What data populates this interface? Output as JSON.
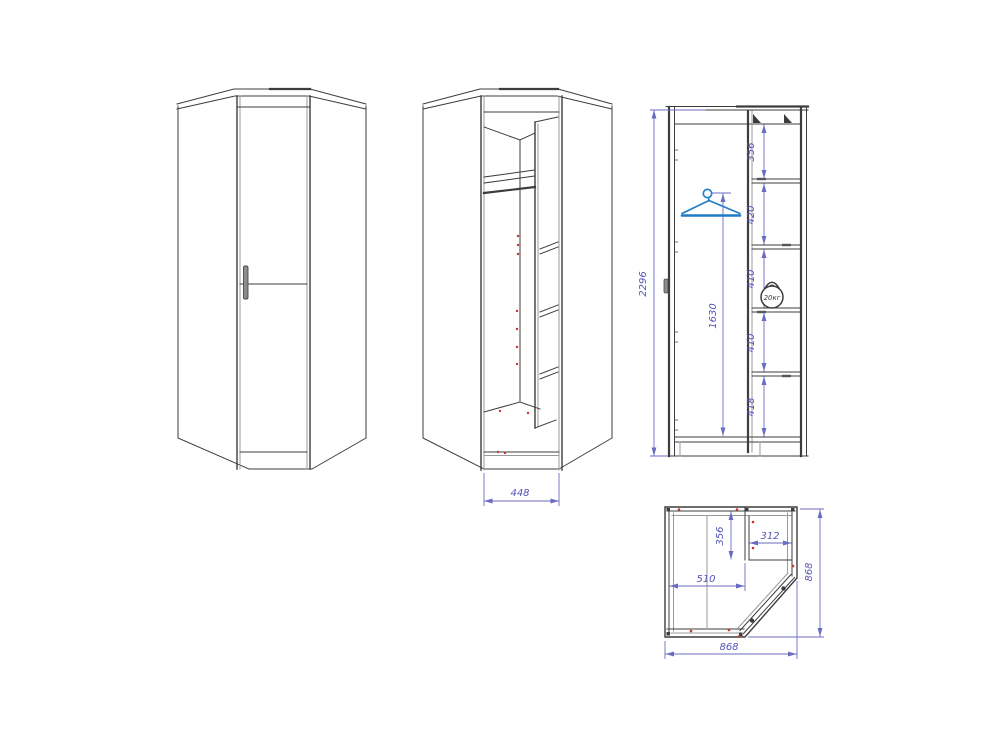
{
  "colors": {
    "outline": "#3d3d3d",
    "outline_light": "#9a9a9a",
    "dimension_line": "#6b6bc2",
    "dimension_text": "#5454b6",
    "hanger_blue": "#1d7cc8",
    "marker_red": "#c63434",
    "background": "#ffffff"
  },
  "views": {
    "front_open": {
      "dims": {
        "opening_width": "448"
      }
    },
    "side_section": {
      "dims": {
        "overall_height": "2296",
        "rod_height": "1630",
        "top_to_shelf1": "356",
        "shelf1_to_shelf2": "420",
        "shelf2_to_shelf3": "410",
        "shelf3_to_shelf4": "410",
        "shelf4_to_bottom": "418"
      },
      "load_badge": "20кг"
    },
    "plan": {
      "dims": {
        "overall_width": "868",
        "overall_depth": "868",
        "left_wall_to_divider": "510",
        "shelf_bay_width": "312",
        "shelf_bay_depth": "356"
      }
    }
  }
}
